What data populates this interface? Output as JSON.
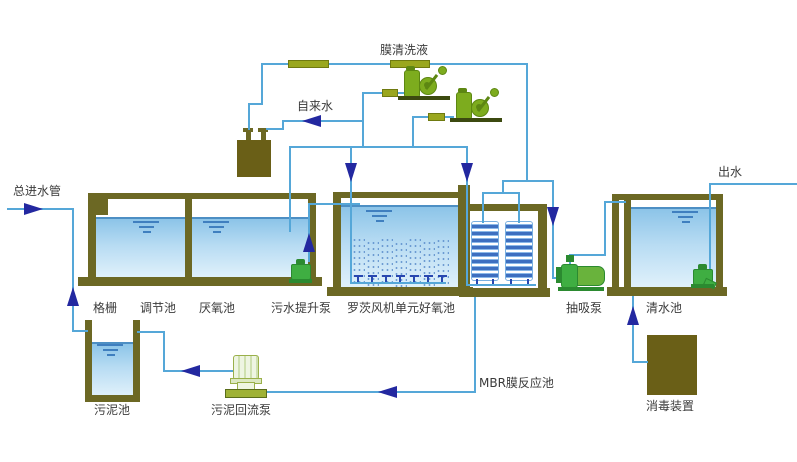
{
  "diagram": {
    "type": "wastewater-treatment-process-flow",
    "labels": {
      "main_inlet": "总进水管",
      "membrane_cleaning_liquid": "膜清洗液",
      "tap_water": "自来水",
      "outlet": "出水",
      "bar_screen": "格栅",
      "regulating_tank": "调节池",
      "anaerobic_tank": "厌氧池",
      "sewage_lift_pump": "污水提升泵",
      "roots_blower_aerobic_tank": "罗茨风机单元好氧池",
      "suction_pump": "抽吸泵",
      "clean_water_tank": "清水池",
      "sludge_tank": "污泥池",
      "sludge_return_pump": "污泥回流泵",
      "mbr_membrane_tank": "MBR膜反应池",
      "disinfection_device": "消毒装置"
    },
    "colors": {
      "pipe": "#55a7d8",
      "flow_arrow": "#2328a0",
      "tank_wall": "#6c6824",
      "solid_box": "#6a5f17",
      "valve": "#9aa71e",
      "blower_green": "#7dac1e",
      "pump_green": "#3fae42",
      "water_top": "#8cc4e8",
      "water_bottom": "#e2f2fb",
      "membrane_blue": "#3d6fc0"
    }
  }
}
